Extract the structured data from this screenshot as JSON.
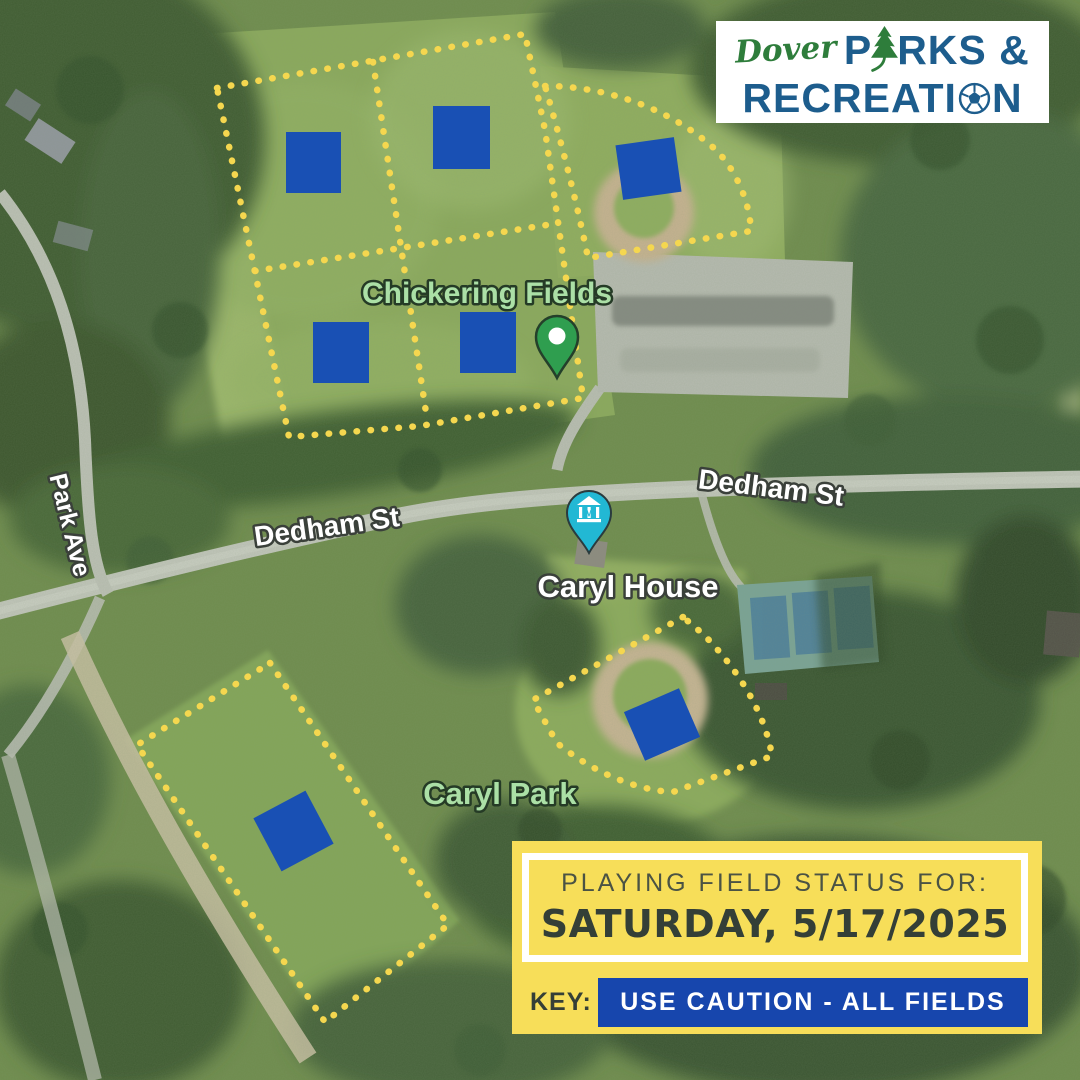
{
  "logo": {
    "script": "Dover",
    "word1_pre": "P",
    "word1_post": "RKS &",
    "word2_pre": "RECREATI",
    "word2_post": "N"
  },
  "map_labels": {
    "chickering": "Chickering Fields",
    "dedham_left": "Dedham St",
    "dedham_right": "Dedham St",
    "park_ave": "Park Ave",
    "caryl_house": "Caryl House",
    "caryl_park": "Caryl Park"
  },
  "map_pins": {
    "museum_glyph": "M"
  },
  "status_panel": {
    "title": "PLAYING FIELD STATUS FOR:",
    "date": "SATURDAY, 5/17/2025",
    "key_label": "KEY:",
    "key_value": "USE CAUTION - ALL FIELDS"
  },
  "colors": {
    "status_yellow": "#f7de59",
    "key_blue": "#1746ad",
    "marker_blue": "#1950b4",
    "dot_yellow": "#f5d74f",
    "logo_blue": "#1d5d8d",
    "logo_green": "#2e7d3b",
    "pin_green": "#2f9e4f",
    "pin_teal": "#22b8d4",
    "date_text": "#343f37"
  },
  "field_markers": [
    {
      "x": 286,
      "y": 132,
      "w": 55,
      "h": 61,
      "rot": 0
    },
    {
      "x": 433,
      "y": 106,
      "w": 57,
      "h": 63,
      "rot": 0
    },
    {
      "x": 619,
      "y": 141,
      "w": 59,
      "h": 55,
      "rot": -8
    },
    {
      "x": 313,
      "y": 322,
      "w": 56,
      "h": 61,
      "rot": 0
    },
    {
      "x": 460,
      "y": 312,
      "w": 56,
      "h": 61,
      "rot": 0
    },
    {
      "x": 632,
      "y": 698,
      "w": 60,
      "h": 53,
      "rot": -23.5
    },
    {
      "x": 264,
      "y": 801,
      "w": 59,
      "h": 60,
      "rot": -28
    }
  ]
}
